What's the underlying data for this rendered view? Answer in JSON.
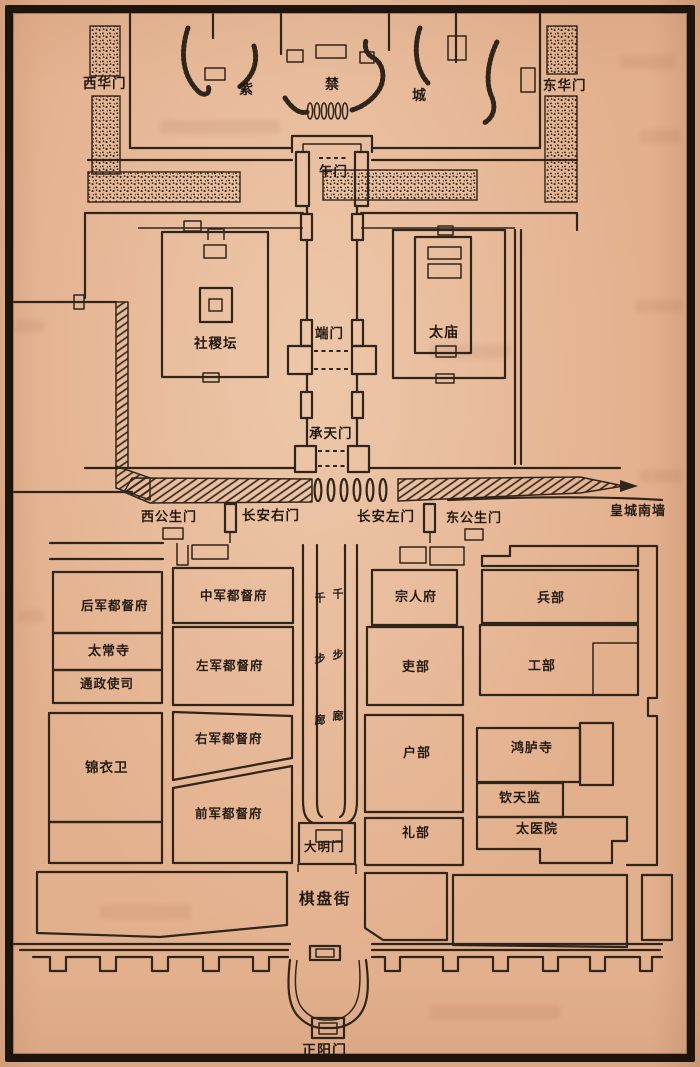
{
  "map": {
    "top_gates": {
      "west": "西华门",
      "east": "东华门"
    },
    "forbidden_city_chars": {
      "c1": "紫",
      "c2": "禁",
      "c3": "城"
    },
    "axis_gates": {
      "wumen": "午门",
      "duanmen": "端门",
      "chengtianmen": "承天门",
      "damingmen": "大明门",
      "zhengyangmen": "正阳门"
    },
    "compounds": {
      "shejitan": "社稷坛",
      "taimiao": "太庙"
    },
    "wall_row": {
      "xigongshengmen": "西公生门",
      "changanyoumen": "长安右门",
      "changanzuomen": "长安左门",
      "donggongshengmen": "东公生门",
      "huangcheng_nanqiang": "皇城南墙"
    },
    "corridor_label": "千步廊",
    "offices": {
      "left_outer": [
        "后军都督府",
        "太常寺",
        "通政使司",
        "锦衣卫"
      ],
      "left_inner": [
        "中军都督府",
        "左军都督府",
        "右军都督府",
        "前军都督府"
      ],
      "right_inner": [
        "宗人府",
        "吏部",
        "户部",
        "礼部"
      ],
      "right_outer": [
        "兵部",
        "工部",
        "鸿胪寺",
        "钦天监",
        "太医院"
      ]
    },
    "street_label": "棋盘街"
  }
}
